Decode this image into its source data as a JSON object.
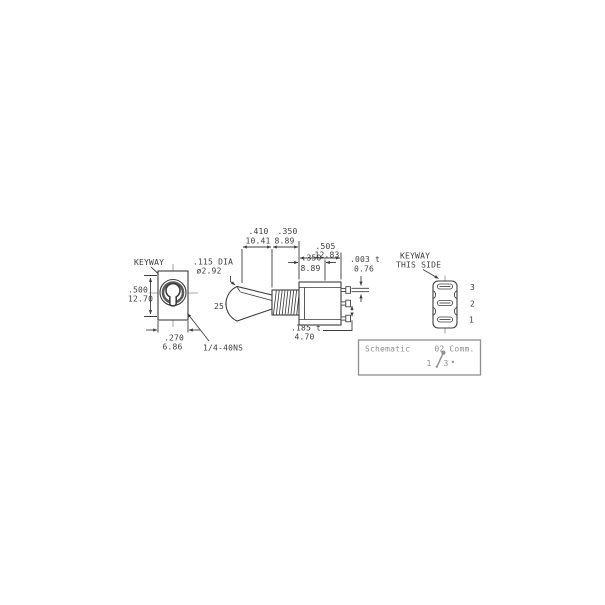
{
  "drawing_title": "toggle switch dimensional drawing",
  "front_view": {
    "keyway_label": "KEYWAY",
    "height": {
      "in": ".500",
      "mm": "12.70"
    },
    "width": {
      "in": ".270",
      "mm": "6.86"
    },
    "thread": "1/4-40NS"
  },
  "side_view": {
    "lever_dia": {
      "in": ".115 DIA",
      "mm": "ø2.92"
    },
    "angle": "25°",
    "dims": {
      "lever": {
        "in": ".410",
        "mm": "10.41"
      },
      "bushing": {
        "in": ".350",
        "mm": "8.89"
      },
      "body": {
        "in": ".505",
        "mm": "12.83"
      },
      "mount": {
        "in": ".350",
        "mm": "8.89"
      },
      "terminal_thickness": {
        "in": ".003 t",
        "mm": "0.76"
      },
      "terminal_spacing": {
        "in": ".185 t",
        "mm": "4.70"
      }
    }
  },
  "terminal_view": {
    "note_line1": "KEYWAY",
    "note_line2": "THIS SIDE",
    "pins": [
      "3",
      "2",
      "1"
    ]
  },
  "schematic": {
    "title": "Schematic",
    "common_note": "02 Comm.",
    "terminal_left": "1",
    "terminal_right": "3",
    "dot": "•"
  },
  "colors": {
    "line": "#3d3d3d",
    "light": "#8f8f8f",
    "background": "#ffffff"
  }
}
